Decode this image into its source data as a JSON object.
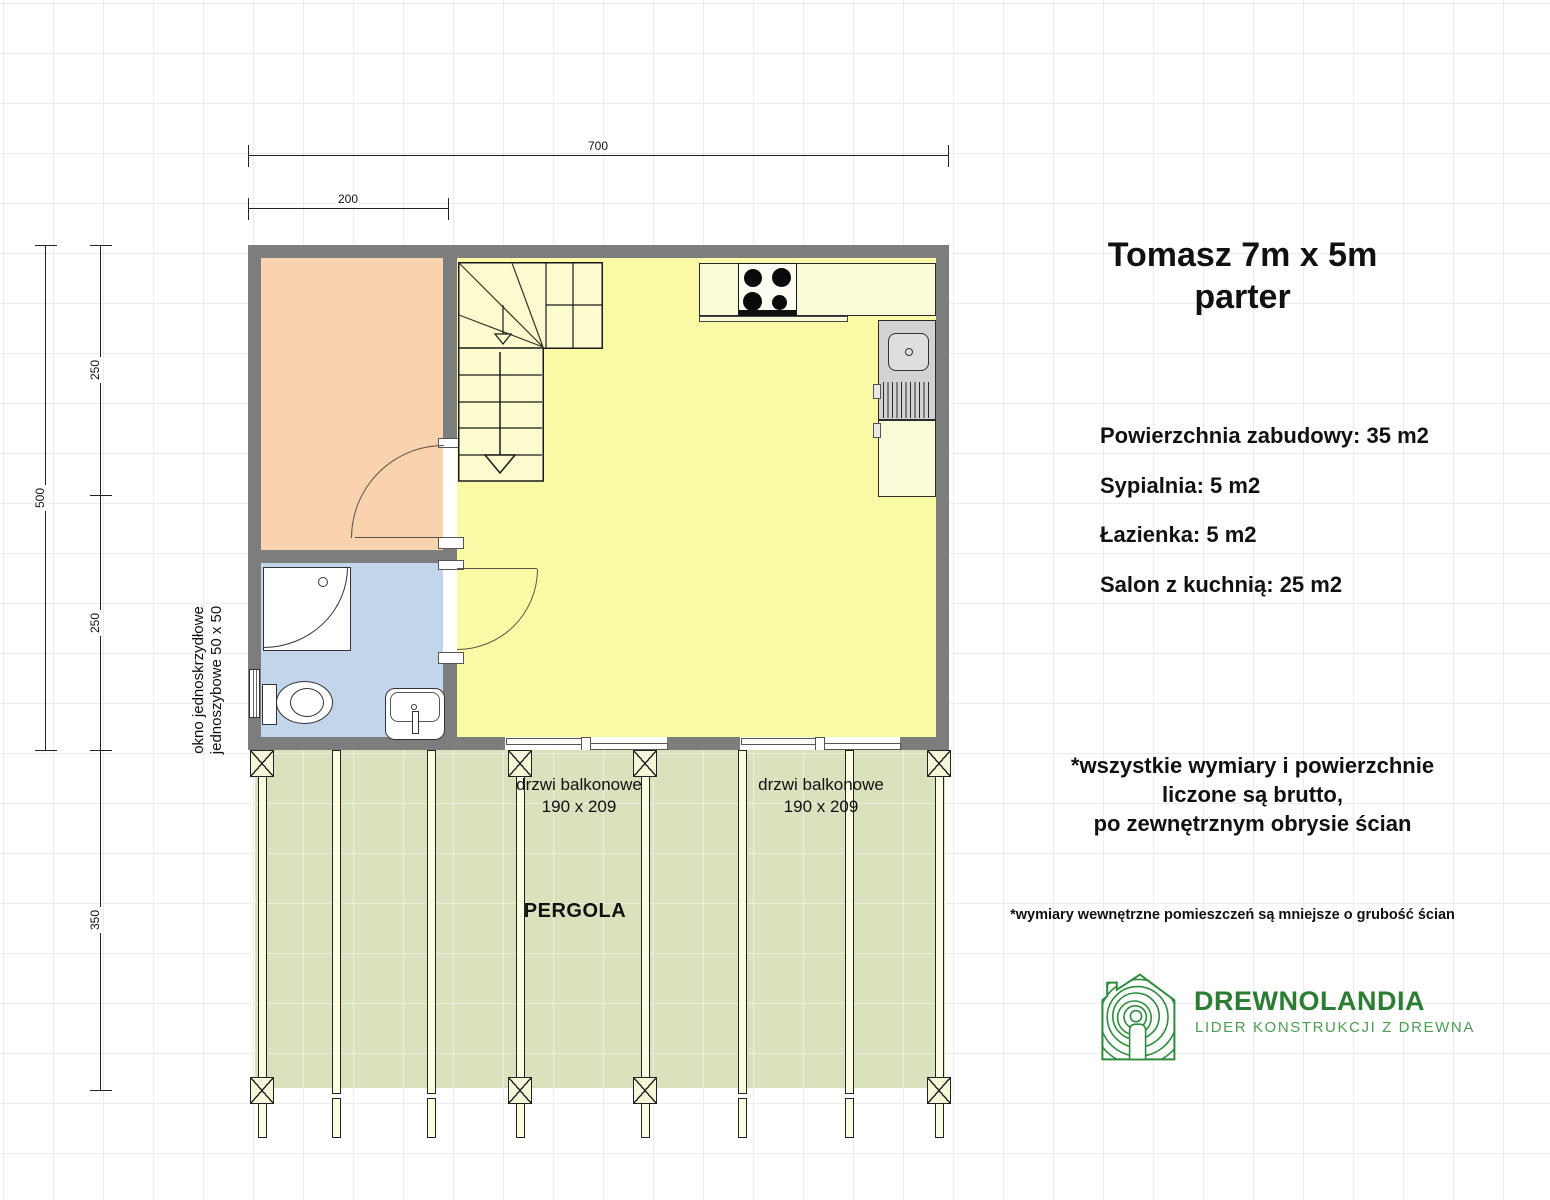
{
  "title": {
    "line1": "Tomasz 7m x 5m",
    "line2": "parter"
  },
  "info": {
    "total": "Powierzchnia zabudowy: 35 m2",
    "bedroom": "Sypialnia: 5 m2",
    "bathroom": "Łazienka: 5 m2",
    "living": "Salon z kuchnią: 25 m2"
  },
  "notes": {
    "gross_line1": "*wszystkie wymiary i powierzchnie",
    "gross_line2": "liczone są brutto,",
    "gross_line3": "po zewnętrznym obrysie ścian",
    "internal": "*wymiary wewnętrzne pomieszczeń są mniejsze o grubość ścian"
  },
  "dimensions": {
    "total_width": "700",
    "bedroom_width": "200",
    "total_height": "500",
    "upper_height": "250",
    "lower_height": "250",
    "pergola_depth": "350"
  },
  "plan_labels": {
    "window_line1": "okno jednoskrzydłowe",
    "window_line2": "jednoszybowe 50 x 50",
    "balcony_door_line1": "drzwi balkonowe",
    "balcony_door_line2": "190 x 209",
    "pergola": "PERGOLA"
  },
  "logo": {
    "name": "DREWNOLANDIA",
    "tagline": "LIDER KONSTRUKCJI Z DREWNA"
  },
  "colors": {
    "wall": "#7c7d7d",
    "bedroom": "#f9d3ae",
    "bathroom": "#c2d5eb",
    "living": "#fafaa6",
    "stairs": "#fbfbce",
    "kitchen_counter": "#fafad8",
    "sink_unit": "#d2d2d2",
    "pergola_green": "#d9e2bd",
    "rafter": "#fcfce0",
    "logo_green": "#2e8b3c"
  }
}
